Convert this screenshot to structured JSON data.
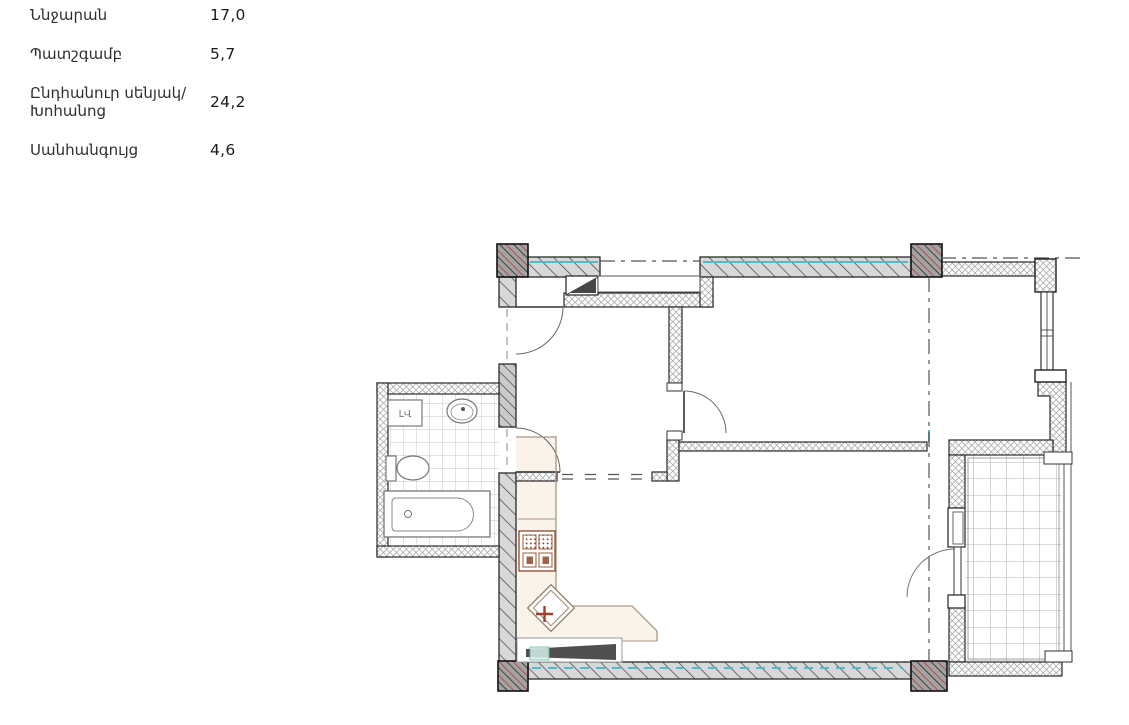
{
  "legend": {
    "items": [
      {
        "label": "Ննջարան",
        "value": "17,0"
      },
      {
        "label": "Պատշգամբ",
        "value": "5,7"
      },
      {
        "label": "Ընդհանուր սենյակ/Խոհանոց",
        "value": "24,2"
      },
      {
        "label": "Սանհանգույց",
        "value": "4,6"
      }
    ]
  },
  "plan": {
    "washer_label": "ԼՎ",
    "colors": {
      "wall_hatch": "#d8d8d8",
      "column": "#a3a3a3",
      "accent_teal": "#57b8c9",
      "accent_red": "#b25454",
      "fixture_brown": "#8d4a2e",
      "counter_fill": "#faf3ea"
    }
  }
}
